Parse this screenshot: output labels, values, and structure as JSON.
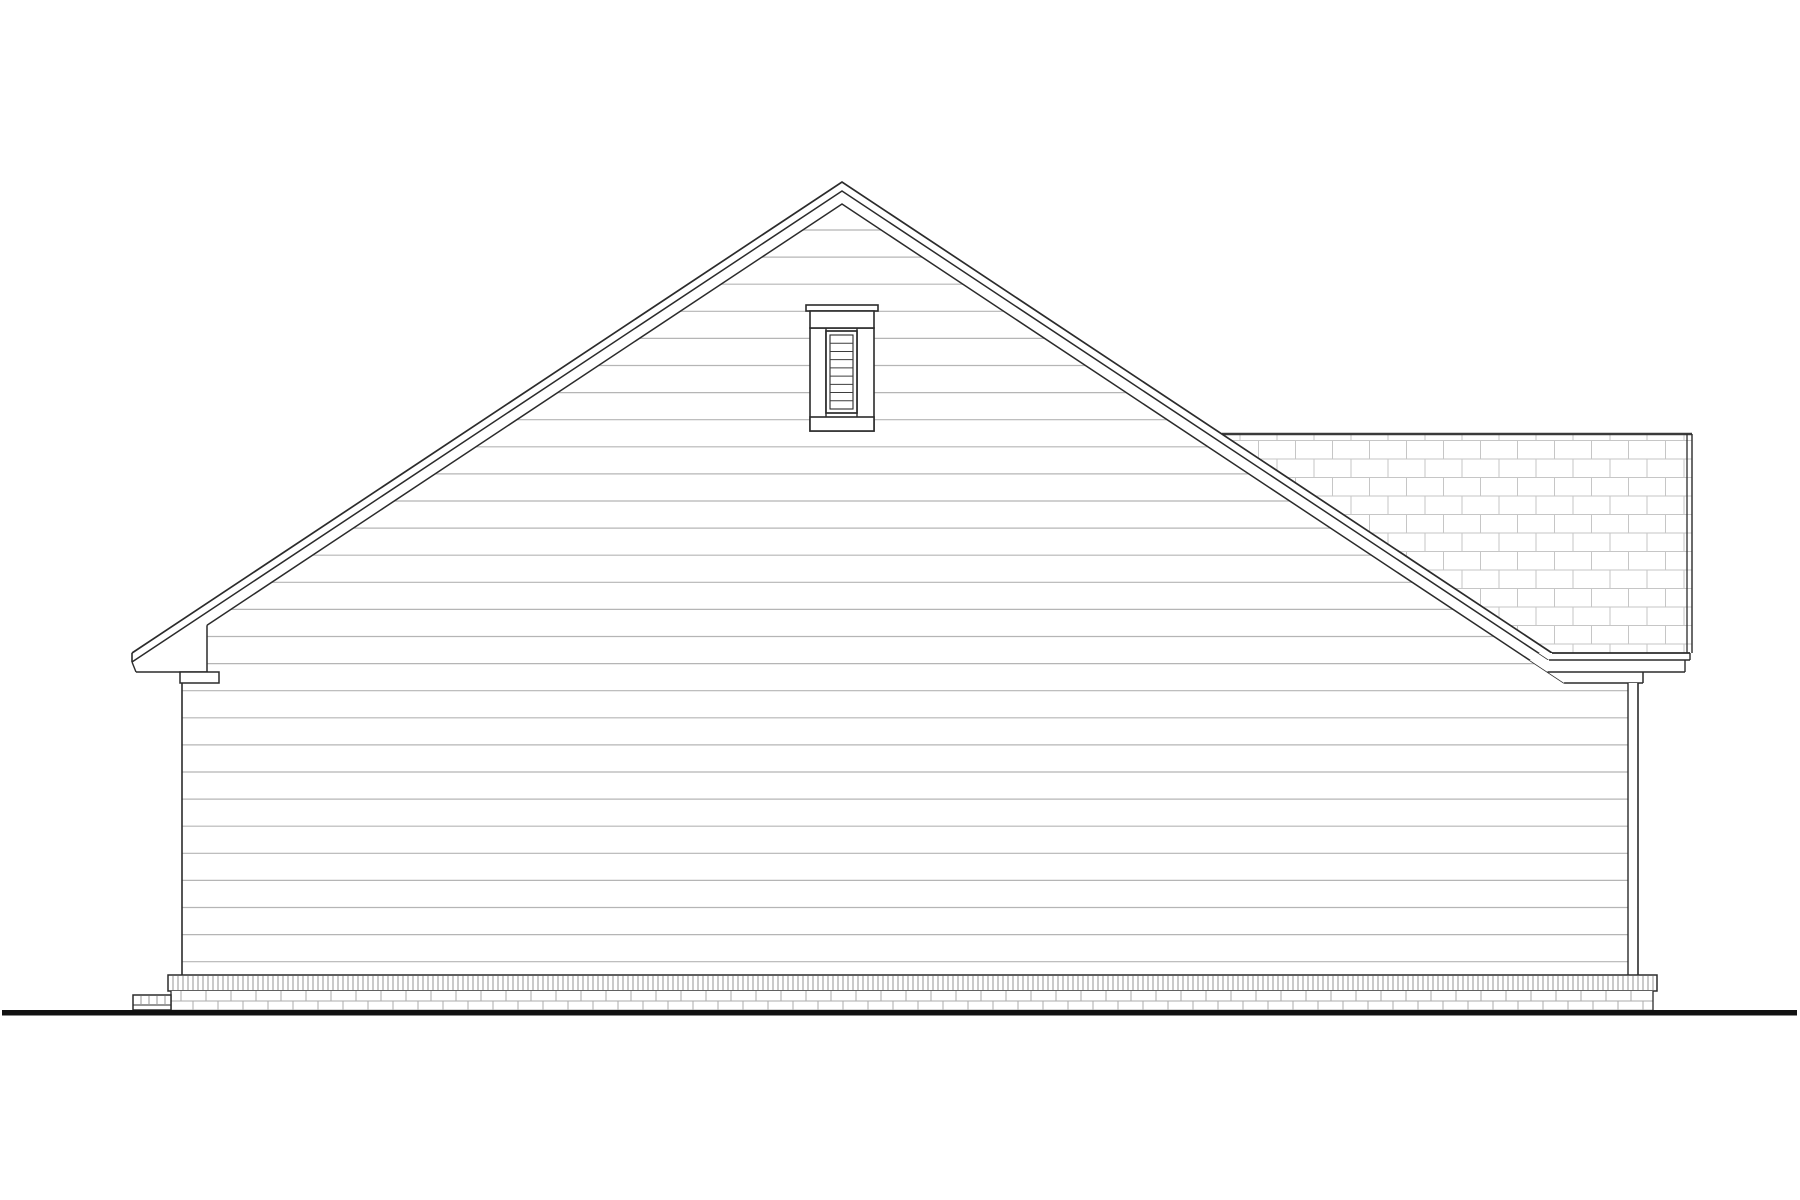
{
  "document": {
    "type": "architectural-elevation-line-drawing",
    "subject": "house side elevation with gable roof, attic louver vent, shingled secondary roof, siding, brick foundation and ground line",
    "background": "#ffffff"
  },
  "drawing": {
    "canvas": {
      "w": 1800,
      "h": 1200
    },
    "palette": {
      "fill": "#ffffff",
      "line": "#2b2b2b",
      "siding_line": "#b5b5b5",
      "shingle_line": "#c6c6c6",
      "ridge": "#3a3a3a",
      "soldier_tick": "#8a8a8a",
      "brick_line": "#ababab",
      "ground": "#111111",
      "slat": "#3d3d3d"
    },
    "roof": {
      "apex_x": 842,
      "apex_y": 182,
      "slope": 0.66338,
      "left_tip_x": 132,
      "eave_top_y": 653,
      "offsets": [
        0,
        9,
        22
      ],
      "left_soffit": {
        "wall_x": 207,
        "bottom_y": 672,
        "bottom_x1": 136
      },
      "left_step": {
        "x1": 180,
        "x2": 219,
        "y1": 672,
        "y2": 683
      },
      "right_bands": [
        {
          "y1": 653,
          "y2": 660,
          "x_right": 1690
        },
        {
          "y1": 660,
          "y2": 672,
          "x_right": 1685
        },
        {
          "y1": 672,
          "y2": 683,
          "x_right": 1643
        }
      ]
    },
    "shingle_roof": {
      "ridge_y": 434,
      "ridge_w": 2.6,
      "right_x": 1692,
      "inner_right_x": 1687,
      "bottom_y": 653,
      "cell_w": 37,
      "row_h": 18.5
    },
    "walls": {
      "left_x": 182,
      "right_x": 1638,
      "corner_board_x": 1628,
      "top_y": 683,
      "bottom_y": 975
    },
    "siding": {
      "spacing": 27.1,
      "base_y": 961.7,
      "top_y": 208
    },
    "vent": {
      "cap": {
        "x1": 806,
        "x2": 878,
        "y1": 305,
        "y2": 311
      },
      "head": {
        "x1": 810,
        "x2": 874,
        "y1": 311,
        "y2": 328
      },
      "jamb_outer": [
        810,
        874
      ],
      "jamb_inner": [
        826,
        857
      ],
      "body_y1": 328,
      "body_y2": 417,
      "sill": {
        "x1": 810,
        "x2": 874,
        "y1": 417,
        "y2": 431
      },
      "louver_outer": {
        "x1": 826,
        "x2": 857,
        "y1": 331,
        "y2": 413
      },
      "louver_inner": {
        "x1": 830,
        "x2": 853,
        "y1": 335,
        "y2": 409
      },
      "slat_count": 8
    },
    "foundation": {
      "soldier": {
        "x1": 168,
        "x2": 1657,
        "y1": 975,
        "y2": 991,
        "tick_step": 5
      },
      "brick": {
        "x1": 171,
        "x2": 1653,
        "y1": 991,
        "y2": 1010,
        "mid_y": 1001,
        "joint_step": 25,
        "row1_phase": 181,
        "row2_phase": 193
      }
    },
    "stoop": {
      "x1": 133,
      "x2": 171,
      "y1": 995,
      "y2": 1010,
      "mid_y": 1005,
      "tick_step": 8
    },
    "ground": {
      "x1": 2,
      "x2": 1797,
      "y": 1010,
      "h": 5.5
    }
  }
}
